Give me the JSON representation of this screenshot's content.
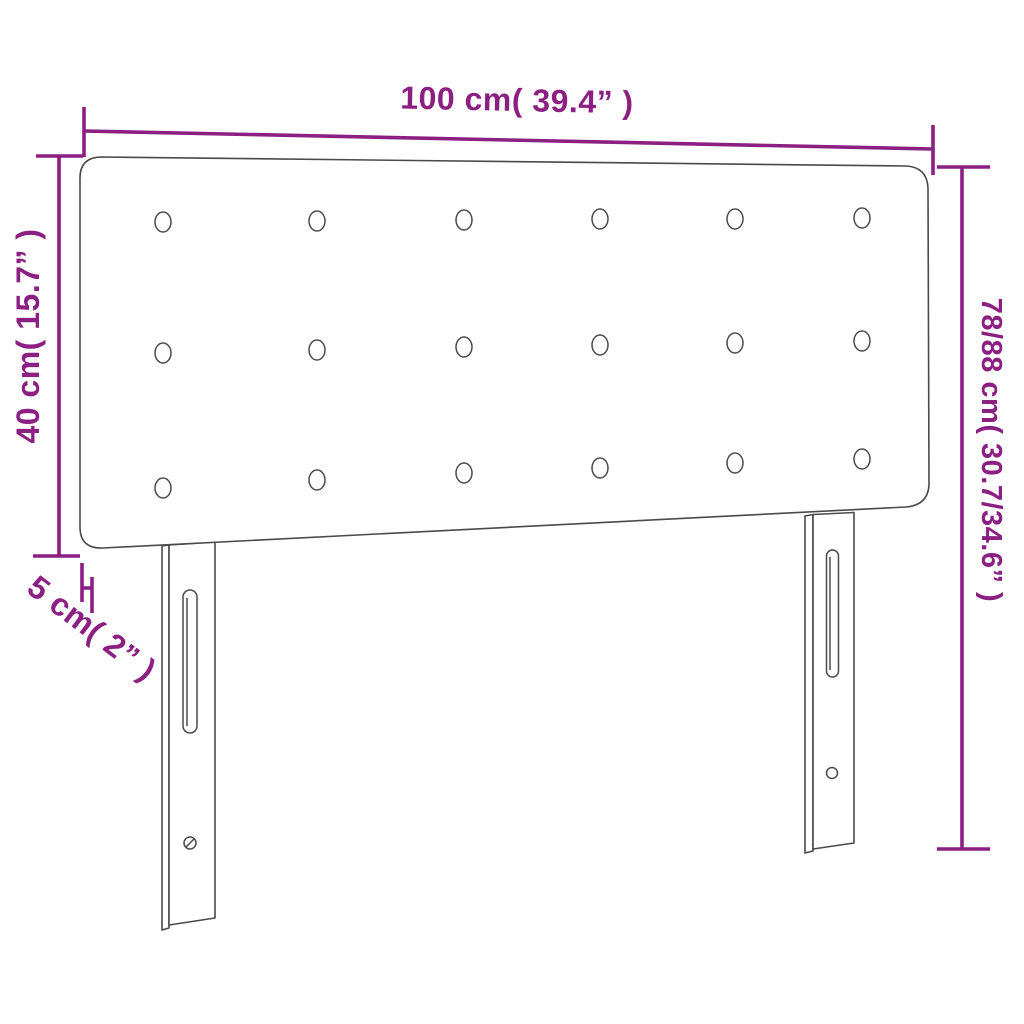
{
  "diagram": {
    "type": "product-dimension-diagram",
    "product": "upholstered headboard with legs",
    "colors": {
      "background": "#ffffff",
      "outline": "#4a4a4a",
      "dimension": "#8B1F82"
    },
    "dimensions": {
      "width": {
        "label": "100 cm( 39.4” )",
        "meaning": "total width"
      },
      "height_left": {
        "label": "40 cm( 15.7” )",
        "meaning": "headboard panel height"
      },
      "height_right": {
        "label": "78/88 cm( 30.7/34.6” )",
        "meaning": "adjustable total height"
      },
      "depth": {
        "label": "5 cm( 2” )",
        "meaning": "panel thickness"
      }
    },
    "buttons": {
      "columns_x": [
        163,
        317,
        464,
        600,
        735,
        862
      ],
      "rows_y": [
        [
          222,
          221,
          220,
          219,
          219,
          218
        ],
        [
          353,
          350,
          347,
          345,
          343,
          341
        ],
        [
          488,
          480,
          473,
          468,
          463,
          459
        ]
      ],
      "rx": 8,
      "ry": 10
    }
  }
}
